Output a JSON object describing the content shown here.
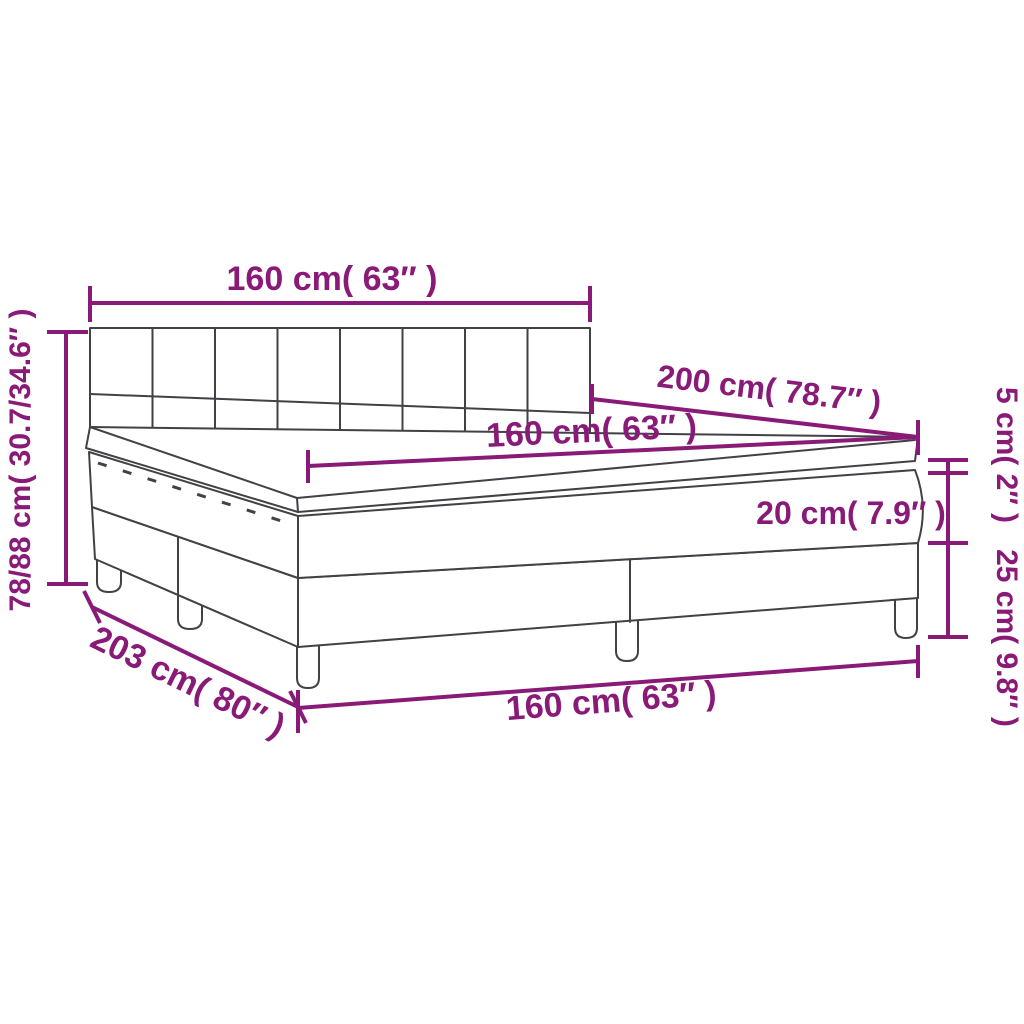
{
  "diagram": {
    "type": "product-dimension-diagram",
    "subject": "box spring bed with headboard, mattress and topper",
    "background_color": "#ffffff",
    "drawing_line_color": "#414146",
    "dimension_color": "#8a1a78",
    "labels": {
      "headboard_width": "160 cm( 63″ )",
      "bed_length": "200 cm( 78.7″ )",
      "mattress_width": "160 cm( 63″ )",
      "topper_height": "5 cm( 2″ )",
      "mattress_height": "20 cm( 7.9″ )",
      "base_height": "25 cm( 9.8″ )",
      "total_height": "78/88 cm( 30.7/34.6″ )",
      "total_length": "203 cm( 80″ )",
      "base_width": "160 cm( 63″ )"
    }
  }
}
